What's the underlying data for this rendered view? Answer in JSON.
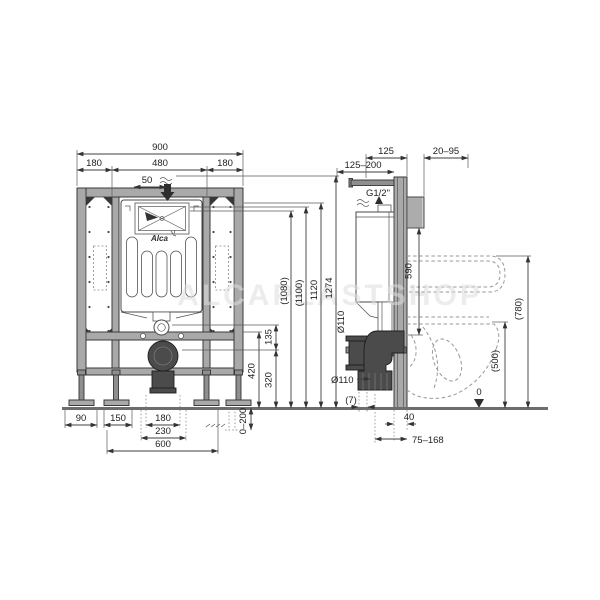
{
  "watermark": "ALCAPLASTSHOP",
  "brand": "Alca",
  "front": {
    "w900": "900",
    "w180l": "180",
    "w480": "480",
    "w180r": "180",
    "w50": "50",
    "v135": "135",
    "v420": "420",
    "v320": "320",
    "v1080": "(1080)",
    "v1100": "(1100)",
    "v1120": "1120",
    "v1274": "1274",
    "b90": "90",
    "b150": "150",
    "b180": "180",
    "b230": "230",
    "b600": "600",
    "adjust": "0–200"
  },
  "side": {
    "t125_200": "125–200",
    "t125": "125",
    "t20_95": "20–95",
    "thread": "G1/2\"",
    "v590": "590",
    "dia_upper": "Ø110",
    "dia_lower": "Ø110",
    "v780": "(780)",
    "v500": "(500)",
    "gap7": "(7)",
    "datum": "0",
    "b40": "40",
    "b75_168": "75–168"
  }
}
